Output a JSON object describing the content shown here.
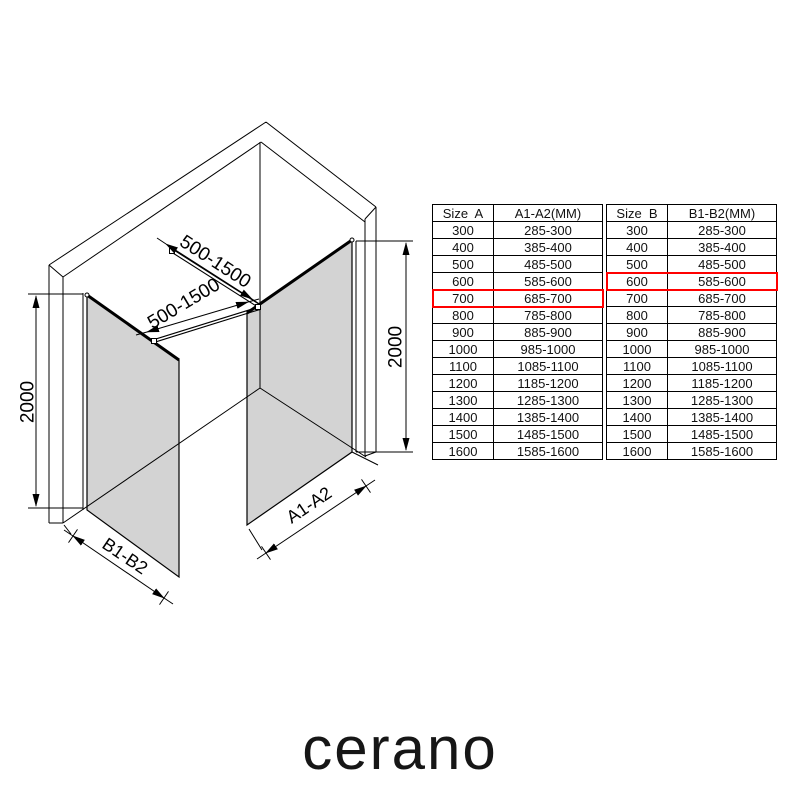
{
  "brand": {
    "logo_text": "cerano"
  },
  "diagram": {
    "labels": {
      "bar_top": "500-1500",
      "bar_bottom": "500-1500",
      "height_left": "2000",
      "height_right": "2000",
      "panel_left": "B1-B2",
      "panel_right": "A1-A2"
    },
    "colors": {
      "glass": "#d3d3d3",
      "line": "#000000",
      "highlight": "#ff0000"
    }
  },
  "tables": [
    {
      "id": "size-a",
      "headers": [
        "Size  A",
        "A1-A2(MM)"
      ],
      "rows": [
        [
          "300",
          "285-300"
        ],
        [
          "400",
          "385-400"
        ],
        [
          "500",
          "485-500"
        ],
        [
          "600",
          "585-600"
        ],
        [
          "700",
          "685-700"
        ],
        [
          "800",
          "785-800"
        ],
        [
          "900",
          "885-900"
        ],
        [
          "1000",
          "985-1000"
        ],
        [
          "1100",
          "1085-1100"
        ],
        [
          "1200",
          "1185-1200"
        ],
        [
          "1300",
          "1285-1300"
        ],
        [
          "1400",
          "1385-1400"
        ],
        [
          "1500",
          "1485-1500"
        ],
        [
          "1600",
          "1585-1600"
        ]
      ],
      "highlight_row_index": 4,
      "highlight_color": "#ff0000"
    },
    {
      "id": "size-b",
      "headers": [
        "Size  B",
        "B1-B2(MM)"
      ],
      "rows": [
        [
          "300",
          "285-300"
        ],
        [
          "400",
          "385-400"
        ],
        [
          "500",
          "485-500"
        ],
        [
          "600",
          "585-600"
        ],
        [
          "700",
          "685-700"
        ],
        [
          "800",
          "785-800"
        ],
        [
          "900",
          "885-900"
        ],
        [
          "1000",
          "985-1000"
        ],
        [
          "1100",
          "1085-1100"
        ],
        [
          "1200",
          "1185-1200"
        ],
        [
          "1300",
          "1285-1300"
        ],
        [
          "1400",
          "1385-1400"
        ],
        [
          "1500",
          "1485-1500"
        ],
        [
          "1600",
          "1585-1600"
        ]
      ],
      "highlight_row_index": 3,
      "highlight_color": "#ff0000"
    }
  ]
}
